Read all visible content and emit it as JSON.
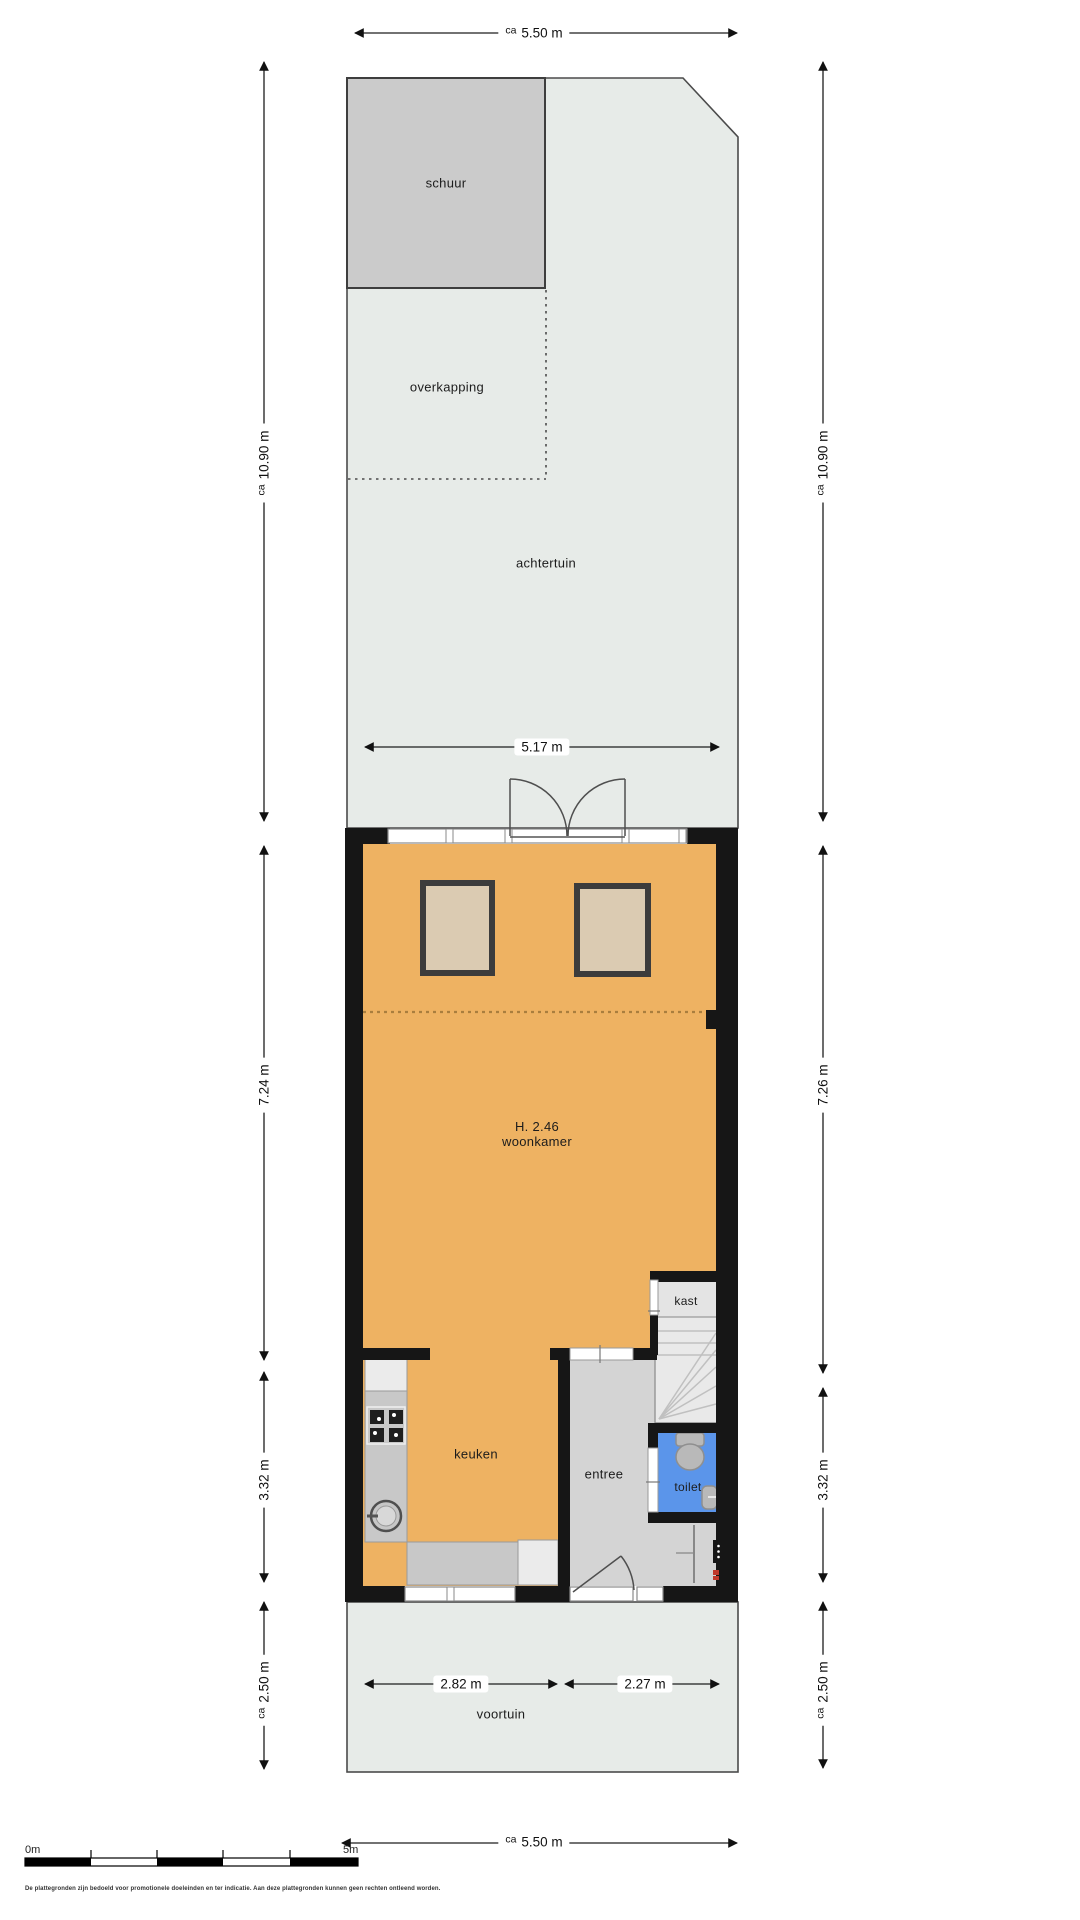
{
  "colors": {
    "wall": "#161616",
    "garden": "#e7ebe8",
    "shed": "#cbcbcb",
    "floor": "#eeb262",
    "entree": "#d4d4d4",
    "kast": "#e4e4e4",
    "stairs": "#e9e9e9",
    "toilet": "#5b95ea",
    "counter": "#c8c8c8",
    "appliance": "#ebebeb",
    "skylight": "#dbcbb2",
    "extension_line": "#a97e3e",
    "fixture": "#b9b9b9",
    "meter_red": "#c0392b"
  },
  "labels": {
    "schuur": "schuur",
    "overkapping": "overkapping",
    "achtertuin": "achtertuin",
    "height": "H. 2.46",
    "woonkamer": "woonkamer",
    "kast": "kast",
    "keuken": "keuken",
    "entree": "entree",
    "toilet": "toilet",
    "voortuin": "voortuin"
  },
  "dims": {
    "top": {
      "ca": "ca",
      "v": "5.50 m"
    },
    "bottom": {
      "ca": "ca",
      "v": "5.50 m"
    },
    "garden_left": {
      "ca": "ca",
      "v": "10.90 m"
    },
    "garden_right": {
      "ca": "ca",
      "v": "10.90 m"
    },
    "rear_inner": "5.17 m",
    "living_left": "7.24 m",
    "living_right": "7.26 m",
    "kitchen_left": "3.32 m",
    "kitchen_right": "3.32 m",
    "front_left": {
      "ca": "ca",
      "v": "2.50 m"
    },
    "front_right": {
      "ca": "ca",
      "v": "2.50 m"
    },
    "facade_left": "2.82 m",
    "facade_right": "2.27 m"
  },
  "scalebar": {
    "zero": "0m",
    "five": "5m"
  },
  "disclaimer": "De plattegronden zijn bedoeld voor promotionele doeleinden en ter indicatie. Aan deze plattegronden kunnen geen rechten ontleend worden."
}
